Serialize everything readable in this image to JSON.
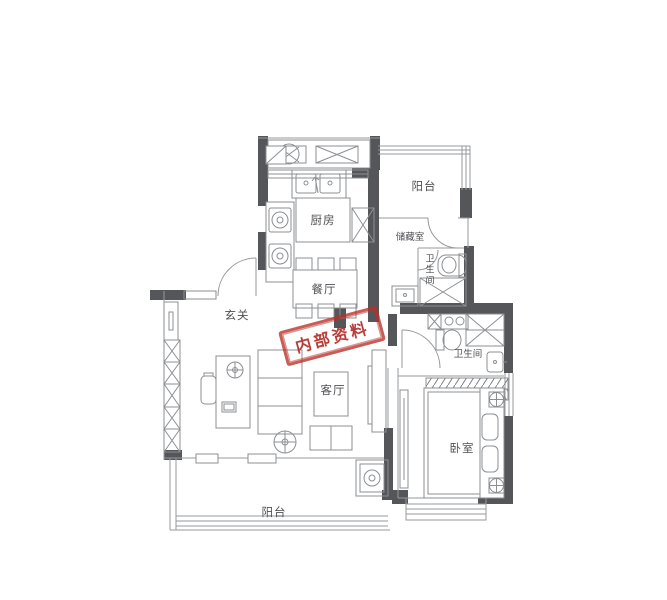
{
  "stamp": {
    "text": "内部资料",
    "color": "#ba2f26"
  },
  "rooms": {
    "balcony_north": {
      "label": "阳台"
    },
    "kitchen": {
      "label": "厨房"
    },
    "storage": {
      "label": "储藏室"
    },
    "bath_top": {
      "label": "卫生间"
    },
    "bath_right": {
      "label": "卫生间"
    },
    "dining": {
      "label": "餐厅"
    },
    "entry": {
      "label": "玄关"
    },
    "living": {
      "label": "客厅"
    },
    "bedroom": {
      "label": "卧室"
    },
    "balcony_south": {
      "label": "阳台"
    }
  },
  "colors": {
    "wall": "#55565a",
    "thin_line": "#97989b",
    "furniture_line": "#8d8f93",
    "stamp_red": "#ba2f26",
    "background": "#ffffff"
  }
}
